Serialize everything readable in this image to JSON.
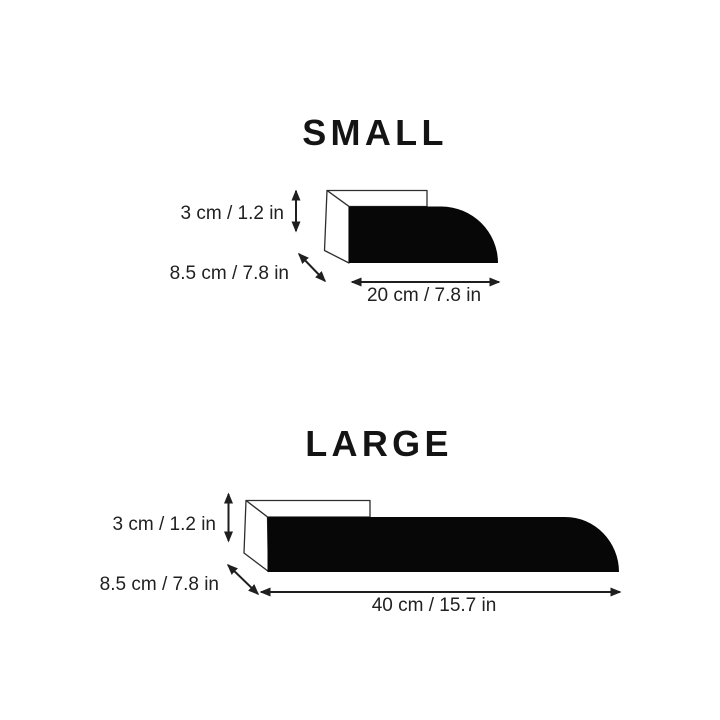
{
  "page": {
    "background": "#ffffff",
    "shape_fill": "#070707",
    "outline_color": "#2e2e2e",
    "arrow_color": "#1f1f1f",
    "label_color": "#212121",
    "title_color": "#141414"
  },
  "sections": [
    {
      "title": "SMALL",
      "dimensions": {
        "height": "3 cm / 1.2 in",
        "depth": "8.5 cm / 7.8 in",
        "length": "20 cm / 7.8 in"
      }
    },
    {
      "title": "LARGE",
      "dimensions": {
        "height": "3 cm / 1.2 in",
        "depth": "8.5 cm / 7.8 in",
        "length": "40 cm / 15.7 in"
      }
    }
  ]
}
